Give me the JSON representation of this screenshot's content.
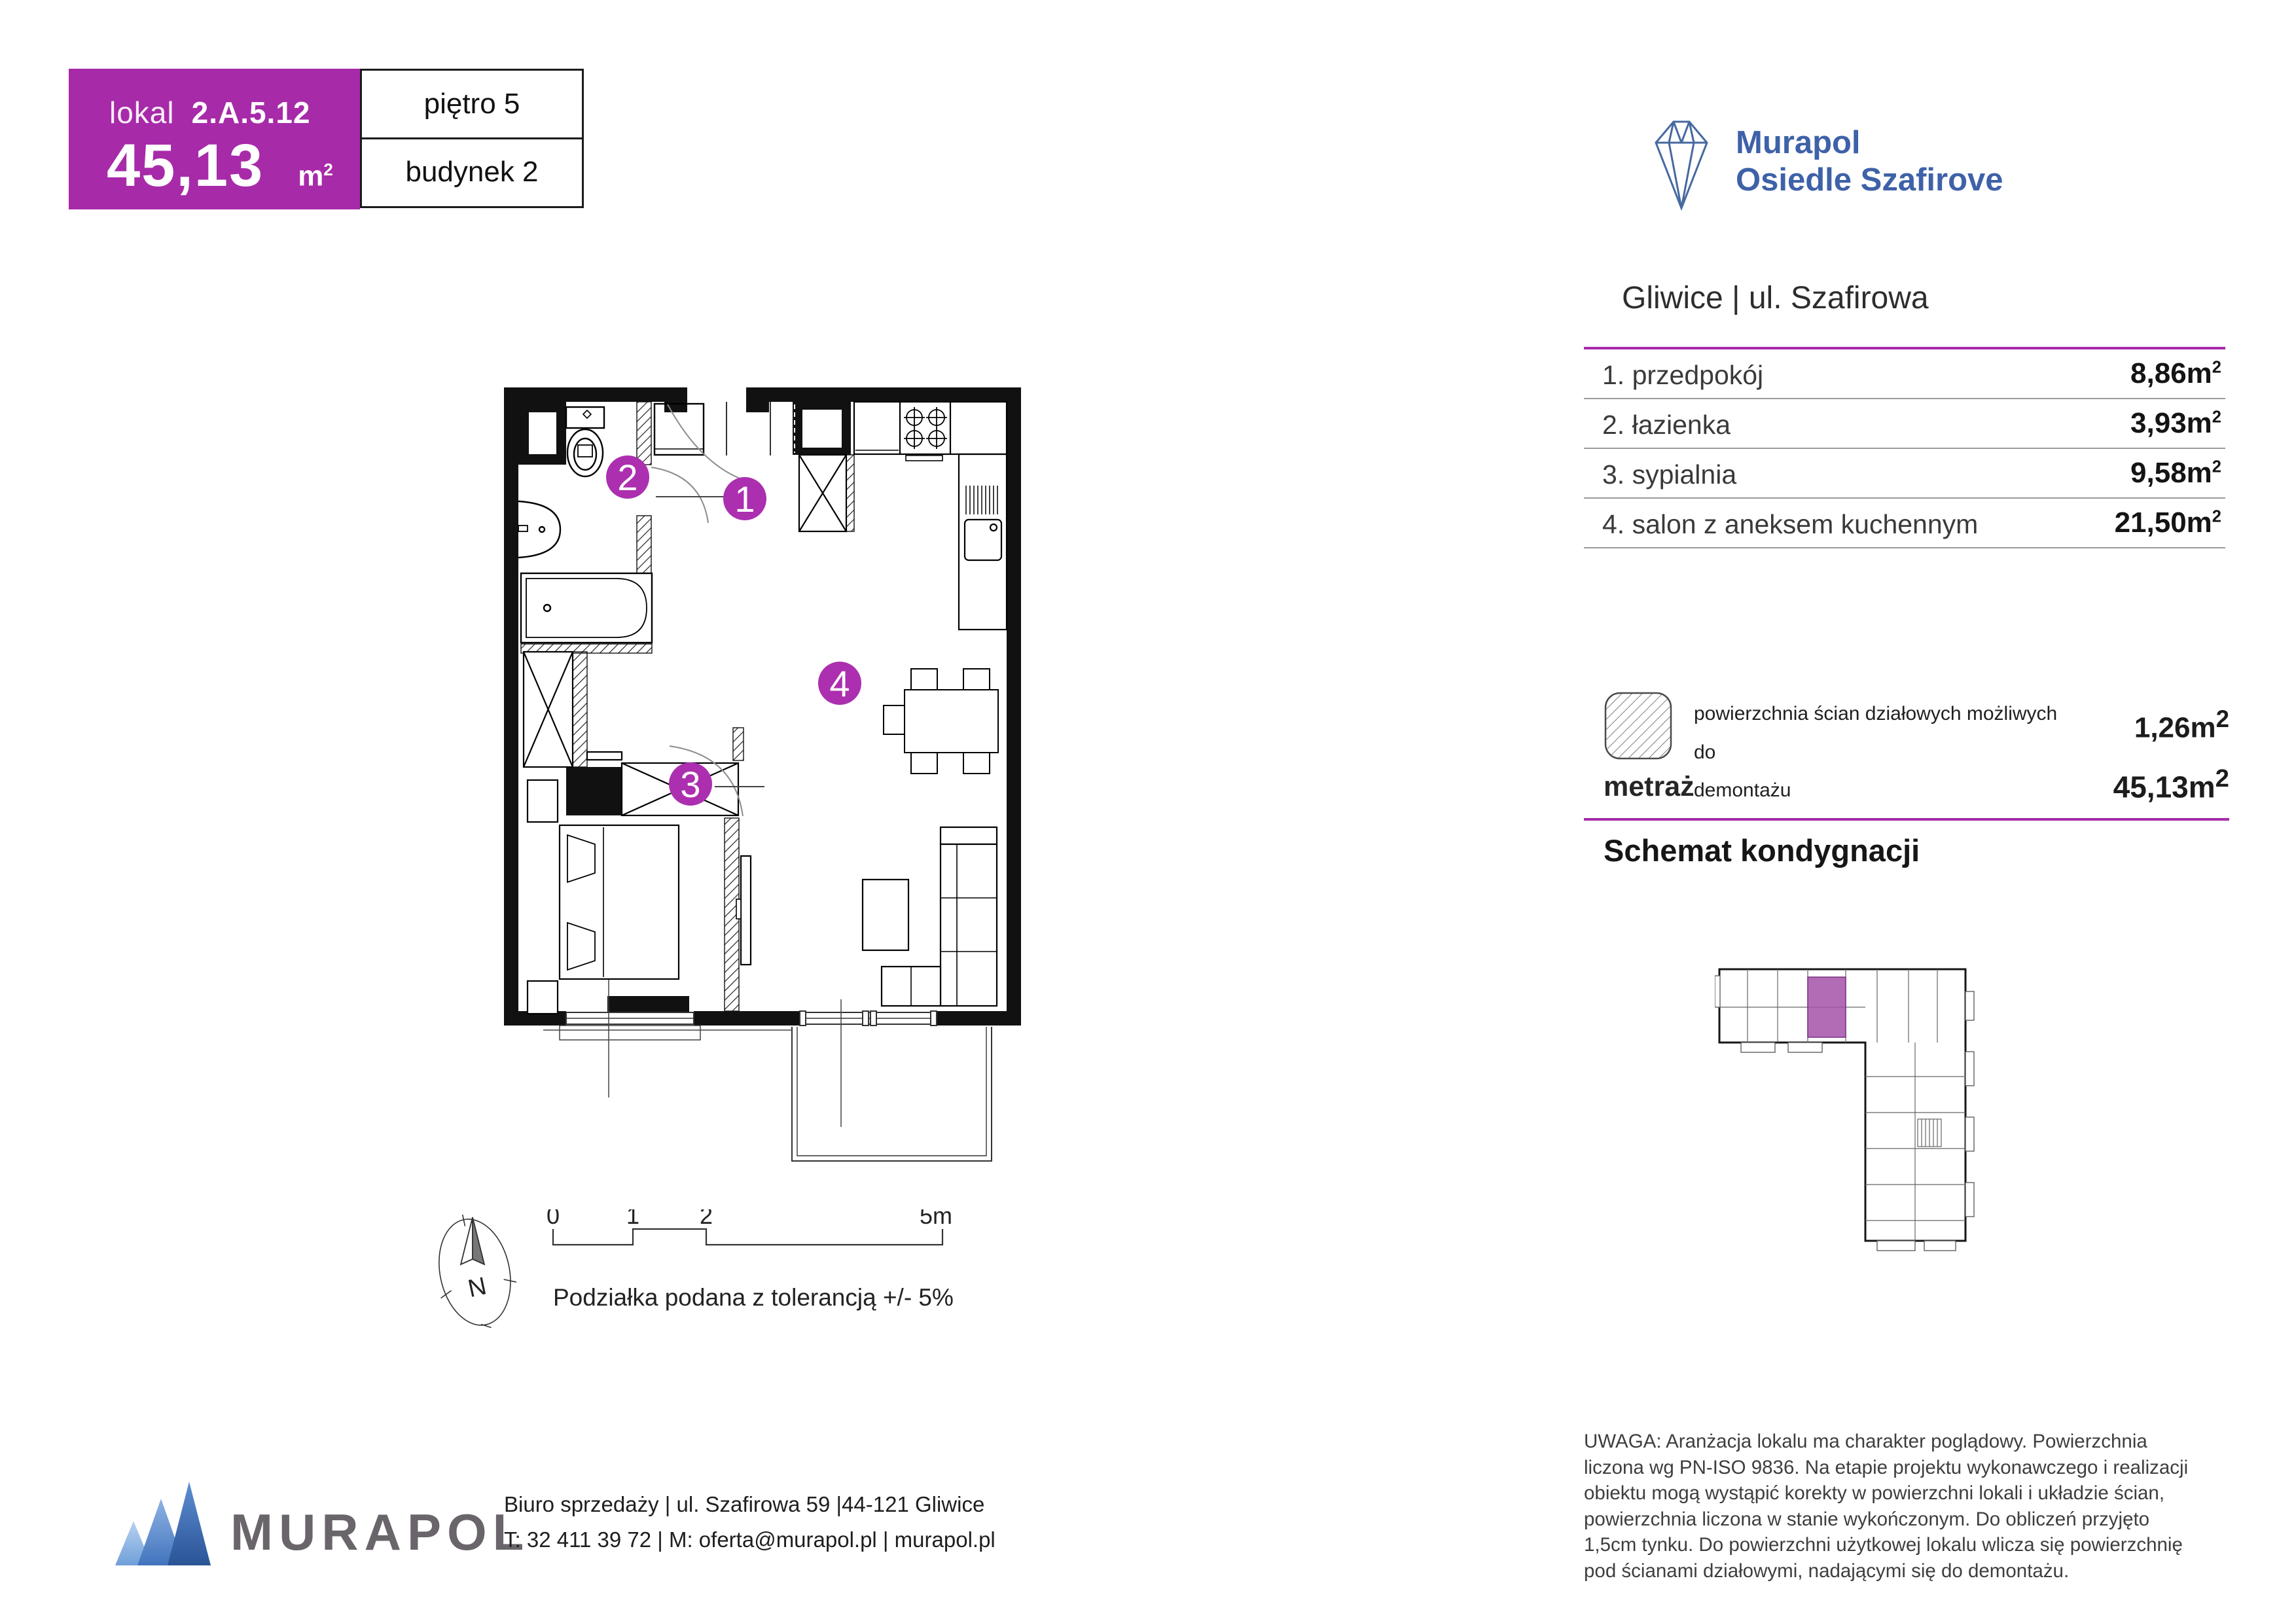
{
  "header": {
    "lokal_label": "lokal",
    "lokal_number": "2.A.5.12",
    "area_value": "45,13",
    "floor": "piętro 5",
    "building": "budynek 2"
  },
  "brand": {
    "name_line1": "Murapol",
    "name_line2": "Osiedle Szafirove",
    "location": "Gliwice | ul. Szafirowa"
  },
  "units": {
    "m": "m",
    "sup": "2"
  },
  "rooms": {
    "rows": [
      {
        "label": "1. przedpokój",
        "value": "8,86"
      },
      {
        "label": "2. łazienka",
        "value": "3,93"
      },
      {
        "label": "3. sypialnia",
        "value": "9,58"
      },
      {
        "label": "4. salon z aneksem kuchennym",
        "value": "21,50"
      }
    ]
  },
  "legend": {
    "text_line1": "powierzchnia ścian działowych możliwych do",
    "text_line2": "demontażu",
    "value": "1,26"
  },
  "metraz": {
    "label": "metraż",
    "value": "45,13"
  },
  "schemat": {
    "title": "Schemat kondygnacji"
  },
  "plan": {
    "numbers": [
      "1",
      "2",
      "3",
      "4"
    ]
  },
  "scalebar": {
    "t0": "0",
    "t1": "1",
    "t2": "2",
    "t5": "5m",
    "caption": "Podziałka podana z tolerancją +/- 5%",
    "north": "N"
  },
  "footer": {
    "logo_text": "MURAPOL",
    "address": "Biuro sprzedaży | ul. Szafirowa 59 |44-121 Gliwice",
    "contact": "T: 32 411 39 72 | M: oferta@murapol.pl | murapol.pl"
  },
  "disclaimer": "UWAGA: Aranżacja lokalu ma charakter poglądowy. Powierzchnia liczona wg PN-ISO 9836. Na etapie projektu wykonawczego i realizacji obiektu mogą wystąpić korekty w powierzchni lokali i układzie ścian, powierzchnia liczona w stanie wykończonym. Do obliczeń przyjęto 1,5cm tynku. Do powierzchni użytkowej lokalu wlicza się powierzchnię pod ścianami działowymi, nadającymi się do demontażu.",
  "colors": {
    "accent": "#A72AA9",
    "logo_blue": "#3E61A8"
  }
}
